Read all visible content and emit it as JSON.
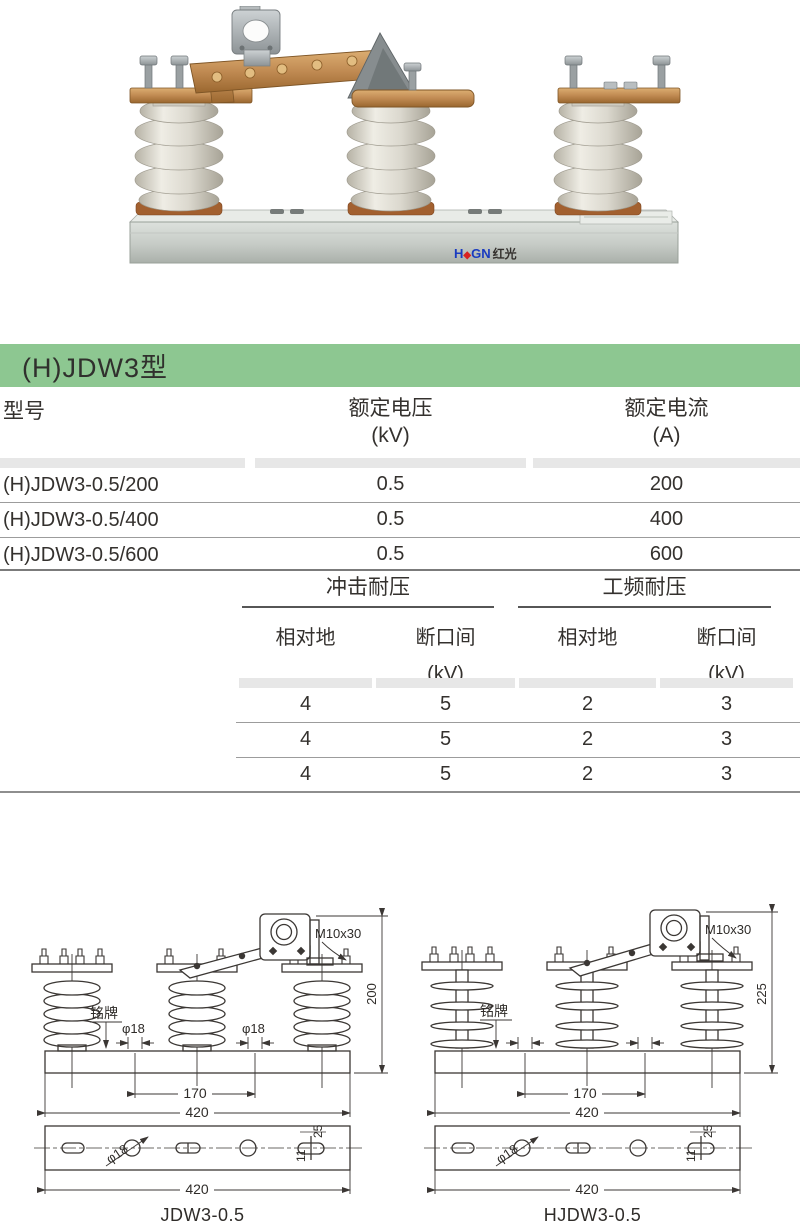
{
  "section": {
    "title": "(H)JDW3型"
  },
  "photo": {
    "logo": {
      "h": "H",
      "diamond": "◆",
      "gn": "GN",
      "cjk": "红光"
    }
  },
  "spec_table": {
    "headers": [
      {
        "line1": "型号",
        "line2": ""
      },
      {
        "line1": "额定电压",
        "line2": "(kV)"
      },
      {
        "line1": "额定电流",
        "line2": "(A)"
      }
    ],
    "rows": [
      {
        "model": "(H)JDW3-0.5/200",
        "voltage": "0.5",
        "current": "200"
      },
      {
        "model": "(H)JDW3-0.5/400",
        "voltage": "0.5",
        "current": "400"
      },
      {
        "model": "(H)JDW3-0.5/600",
        "voltage": "0.5",
        "current": "600"
      }
    ]
  },
  "withstand_table": {
    "groups": [
      {
        "label": "冲击耐压"
      },
      {
        "label": "工频耐压"
      }
    ],
    "subheaders": [
      {
        "line1": "相对地",
        "line2": ""
      },
      {
        "line1": "断口间",
        "line2": "(kV)"
      },
      {
        "line1": "相对地",
        "line2": ""
      },
      {
        "line1": "断口间",
        "line2": "(kV)"
      }
    ],
    "rows": [
      {
        "c1": "4",
        "c2": "5",
        "c3": "2",
        "c4": "3"
      },
      {
        "c1": "4",
        "c2": "5",
        "c3": "2",
        "c4": "3"
      },
      {
        "c1": "4",
        "c2": "5",
        "c3": "2",
        "c4": "3"
      }
    ]
  },
  "drawings": {
    "left": {
      "caption": "JDW3-0.5",
      "labels": {
        "bolt_spec": "M10x30",
        "height": "200",
        "nameplate": "铭牌",
        "hole_dia_1": "φ18",
        "hole_dia_2": "φ18",
        "span_inner": "170",
        "span_outer": "420",
        "bottom_hole_dia": "φ18",
        "slot_width": "25",
        "slot_offset": "11",
        "bottom_width": "420"
      }
    },
    "right": {
      "caption": "HJDW3-0.5",
      "labels": {
        "bolt_spec": "M10x30",
        "height": "225",
        "nameplate": "铭牌",
        "span_inner": "170",
        "span_outer": "420",
        "bottom_hole_dia": "φ18",
        "slot_width": "25",
        "slot_offset": "11",
        "bottom_width": "420"
      }
    }
  },
  "colors": {
    "header_green": "#8dc791",
    "strip_gray": "#e7e7e7"
  }
}
